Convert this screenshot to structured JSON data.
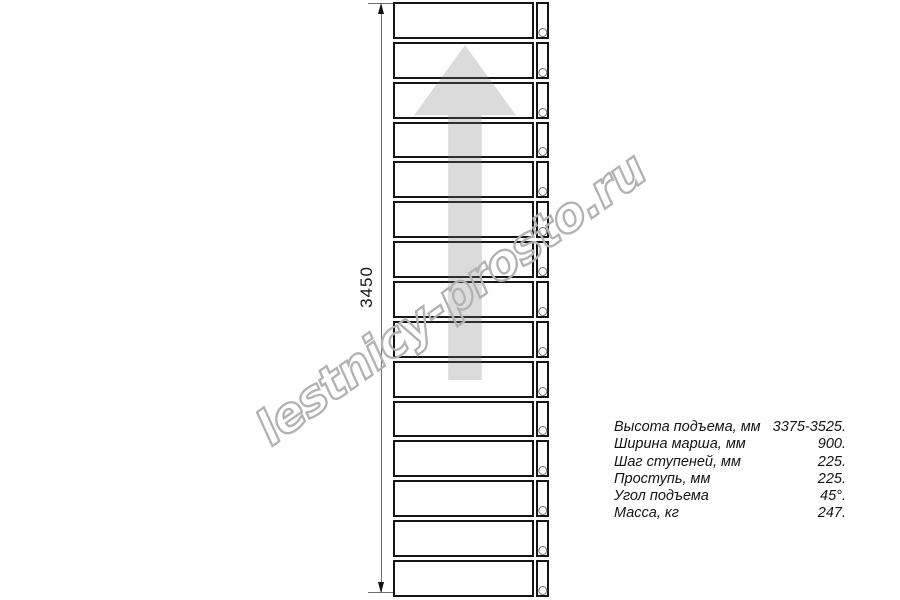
{
  "drawing": {
    "title_hint": "staircase straight flight plan view",
    "dimension": {
      "value": "3450"
    },
    "stairs": {
      "step_count": 15
    },
    "direction_arrow": "up-arrow",
    "watermark": {
      "text": "lestnicy-prosto.ru"
    },
    "specs": [
      {
        "label": "Высота подъема, мм",
        "value": "3375-3525."
      },
      {
        "label": "Ширина марша, мм",
        "value": "900."
      },
      {
        "label": "Шаг ступеней, мм",
        "value": "225."
      },
      {
        "label": "Проступь, мм",
        "value": "225."
      },
      {
        "label": "Угол подъема",
        "value": "45°."
      },
      {
        "label": "Масса, кг",
        "value": "247."
      }
    ],
    "colors": {
      "line": "#141414",
      "arrow_fill": "#d9d9d9",
      "watermark": "#b2b2b2",
      "dimension_line": "#6f6f6f",
      "background": "#ffffff"
    }
  }
}
